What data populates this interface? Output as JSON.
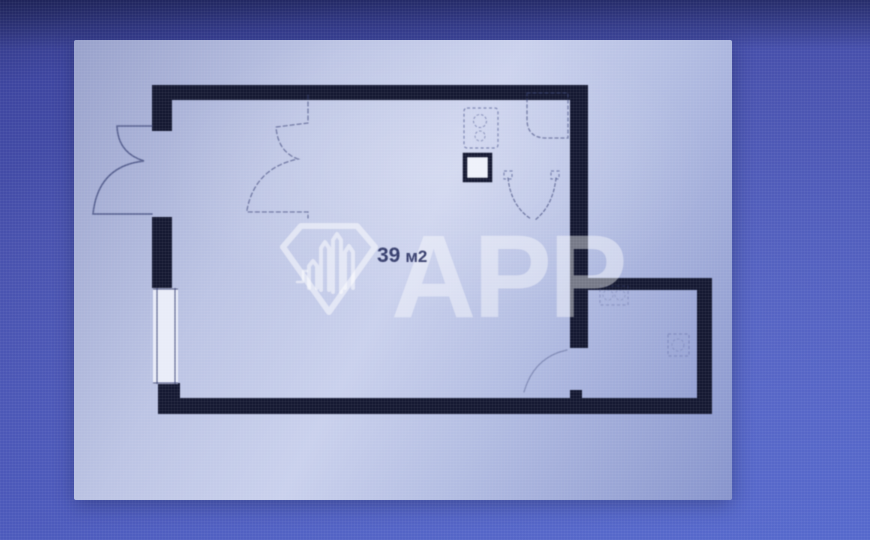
{
  "floor_plan": {
    "area_label": "39 м2",
    "area_value": "39",
    "area_unit": "м2",
    "watermark": {
      "text": "APP",
      "logo_icon": "watermark-diamond-icon"
    },
    "colors": {
      "background_top": "#31377f",
      "background_mid": "#4750ac",
      "background_bottom": "#5366ca",
      "panel_light": "#c9d0ec",
      "panel_shadow": "#8794cc",
      "wall": "#161a33",
      "line": "#3c4578",
      "dashed": "#47518a",
      "window_fill": "#e9ecf8",
      "vent_fill": "#eef1fa",
      "label_text": "#2b3263",
      "watermark_white": "rgba(255,255,255,0.45)"
    },
    "walls": [
      {
        "name": "wall-top",
        "x": 152,
        "y": 85,
        "w": 436,
        "h": 15
      },
      {
        "name": "wall-left-upper",
        "x": 152,
        "y": 85,
        "w": 20,
        "h": 46
      },
      {
        "name": "wall-left-mid",
        "x": 152,
        "y": 217,
        "w": 20,
        "h": 71
      },
      {
        "name": "wall-left-lower",
        "x": 158,
        "y": 383,
        "w": 22,
        "h": 31
      },
      {
        "name": "wall-bottom",
        "x": 158,
        "y": 398,
        "w": 554,
        "h": 16
      },
      {
        "name": "wall-right-main",
        "x": 570,
        "y": 85,
        "w": 18,
        "h": 263
      },
      {
        "name": "wall-right-door-stub",
        "x": 570,
        "y": 390,
        "w": 12,
        "h": 10
      },
      {
        "name": "wall-right-room-top",
        "x": 588,
        "y": 278,
        "w": 124,
        "h": 12
      },
      {
        "name": "wall-right-room-right",
        "x": 697,
        "y": 278,
        "w": 15,
        "h": 136
      }
    ],
    "window": {
      "frame": {
        "x": 153,
        "y": 288,
        "w": 25,
        "h": 96
      },
      "lines": [
        {
          "x1": 157,
          "y1": 288,
          "x2": 157,
          "y2": 384
        },
        {
          "x1": 175,
          "y1": 288,
          "x2": 175,
          "y2": 384
        },
        {
          "x1": 153,
          "y1": 289,
          "x2": 178,
          "y2": 289
        },
        {
          "x1": 153,
          "y1": 383,
          "x2": 178,
          "y2": 383
        }
      ]
    },
    "paths": [
      {
        "name": "entrance-double-door",
        "d": "M 152,126 L 117,126 Q 118,153 144,161 Q 98,166 93,214 L 152,214",
        "w": 1.5,
        "o": 0.75
      },
      {
        "name": "closet-dashed-outline",
        "d": "M 308,95 L 308,123 L 276,127 Q 278,152 298,159 Q 255,168 247,210 L 247,212 L 308,212 L 308,218",
        "dash": "4 3",
        "w": 1.3,
        "o": 0.6
      },
      {
        "name": "bath-door-left-arc",
        "d": "M 508,178 Q 511,206 531,219",
        "dash": "3 2.5",
        "w": 1.2,
        "o": 0.65
      },
      {
        "name": "bath-door-right-arc",
        "d": "M 556,178 Q 553,206 535,220",
        "dash": "3 2.5",
        "w": 1.2,
        "o": 0.65
      },
      {
        "name": "shower-dashed-outline",
        "d": "M 527,93 L 568,93 L 568,138 L 546,138 Q 527,138 527,119 Z",
        "dash": "3 3",
        "w": 1.3,
        "o": 0.6
      },
      {
        "name": "room-door-arc",
        "d": "M 567,350 Q 534,357 524,392",
        "w": 1.2,
        "o": 0.4
      }
    ],
    "fixtures": [
      {
        "name": "kitchen-unit-dashed",
        "type": "rect",
        "x": 464,
        "y": 108,
        "w": 34,
        "h": 40,
        "rx": 3,
        "o": 0.6
      },
      {
        "name": "kitchen-burner-1",
        "type": "circle",
        "cx": 480,
        "cy": 121,
        "r": 6.5,
        "o": 0.55
      },
      {
        "name": "kitchen-burner-2",
        "type": "circle",
        "cx": 480,
        "cy": 136,
        "r": 5,
        "o": 0.5
      },
      {
        "name": "bath-door-left-post",
        "type": "rect",
        "x": 504,
        "y": 171,
        "w": 8,
        "h": 8,
        "o": 0.6
      },
      {
        "name": "bath-door-right-post",
        "type": "rect",
        "x": 551,
        "y": 171,
        "w": 8,
        "h": 8,
        "o": 0.6
      },
      {
        "name": "right-room-fixture-sink",
        "type": "rect",
        "x": 600,
        "y": 286,
        "w": 28,
        "h": 19,
        "o": 0.3
      },
      {
        "name": "right-room-sink-bowl-1",
        "type": "circle",
        "cx": 608,
        "cy": 295,
        "r": 5,
        "o": 0.28
      },
      {
        "name": "right-room-sink-bowl-2",
        "type": "circle",
        "cx": 620,
        "cy": 295,
        "r": 5,
        "o": 0.28
      },
      {
        "name": "right-room-fixture-2",
        "type": "rect",
        "x": 668,
        "y": 334,
        "w": 21,
        "h": 22,
        "o": 0.3
      },
      {
        "name": "right-room-fixture-2-circle",
        "type": "circle",
        "cx": 678,
        "cy": 345,
        "r": 6,
        "o": 0.25
      }
    ],
    "vent": {
      "x": 465,
      "y": 155,
      "w": 25,
      "h": 25
    }
  }
}
